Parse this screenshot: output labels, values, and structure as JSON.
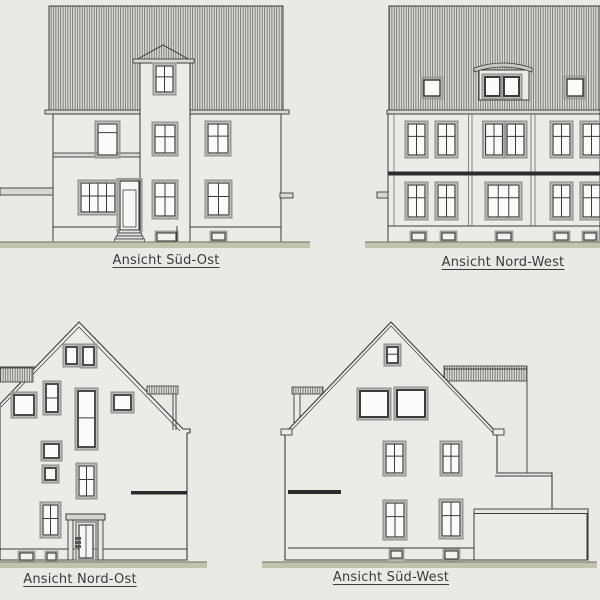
{
  "drawing": {
    "type": "architectural-elevations",
    "labels": {
      "top_left": "Ansicht Süd-Ost",
      "top_right": "Ansicht Nord-West",
      "bottom_left": "Ansicht Nord-Ost",
      "bottom_right": "Ansicht Süd-West"
    },
    "colors": {
      "background": "#e9e9e6",
      "wall": "#ebebe8",
      "roof_fill": "#e0e0dd",
      "roof_hatch_line": "#55554f",
      "outline": "#3b3b3b",
      "frame_gray": "#9c9c98",
      "trim": "#d8d8d4",
      "dark_band": "#2c2c2c",
      "ground": "#c2c2ae",
      "ground_edge": "#838376",
      "label_text": "#3a3a3a"
    }
  }
}
